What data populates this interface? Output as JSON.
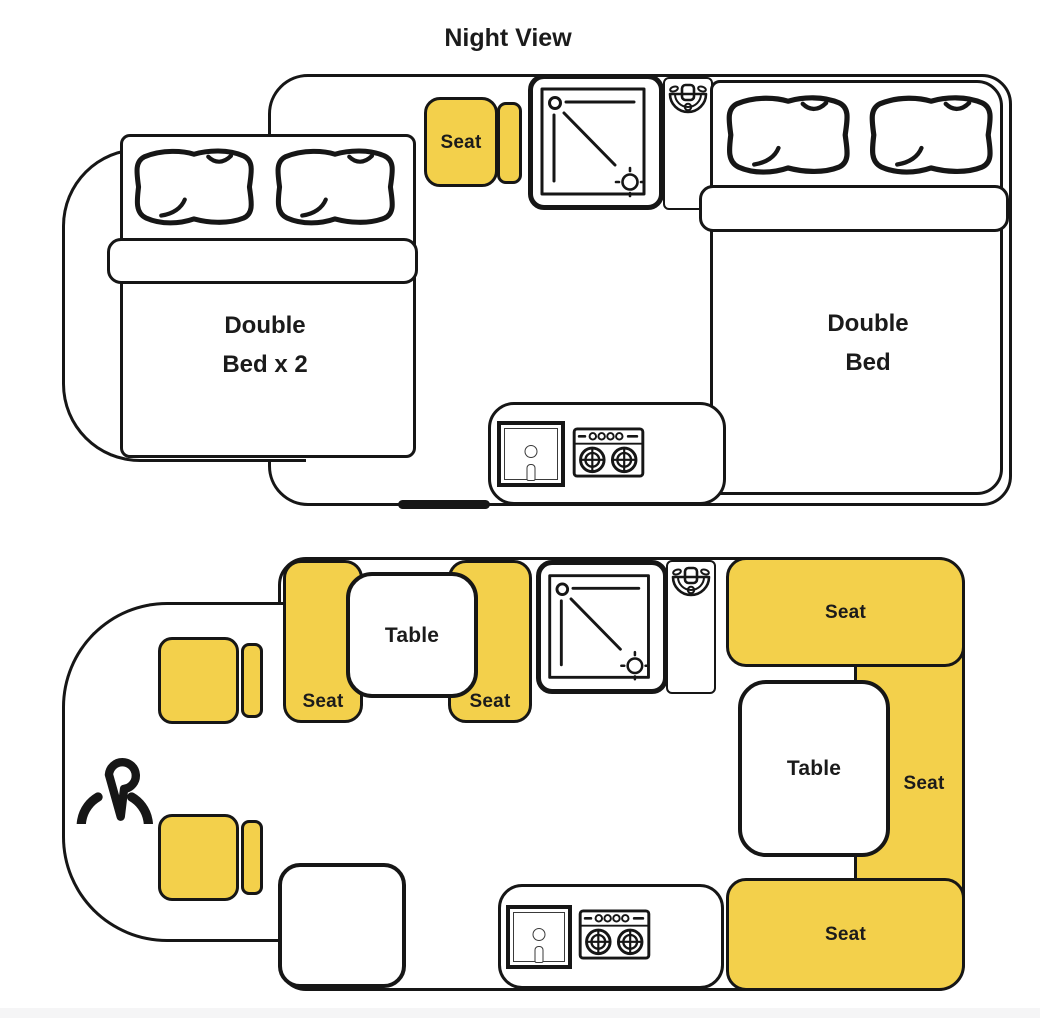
{
  "title": "Night View",
  "colors": {
    "seat": "#F3D04B",
    "line": "#161616",
    "footer": "#F5F5F6"
  },
  "night_view": {
    "front_seat_label": "Seat",
    "cab_bed_label": {
      "line1": "Double",
      "line2": "Bed x 2"
    },
    "rear_bed_label": {
      "line1": "Double",
      "line2": "Bed"
    }
  },
  "day_view": {
    "front_dinette": {
      "left_seat_label": "Seat",
      "right_seat_label": "Seat",
      "table_label": "Table"
    },
    "rear_dinette": {
      "top_seat_label": "Seat",
      "side_seat_label": "Seat",
      "bottom_seat_label": "Seat",
      "table_label": "Table"
    }
  },
  "icons": {
    "brand": "brand-p-logo",
    "shower": "shower-icon",
    "toilet": "toilet-icon",
    "sink": "sink-icon",
    "stove": "stove-icon",
    "pillow": "pillow-icon",
    "door": "sliding-door-marker"
  }
}
